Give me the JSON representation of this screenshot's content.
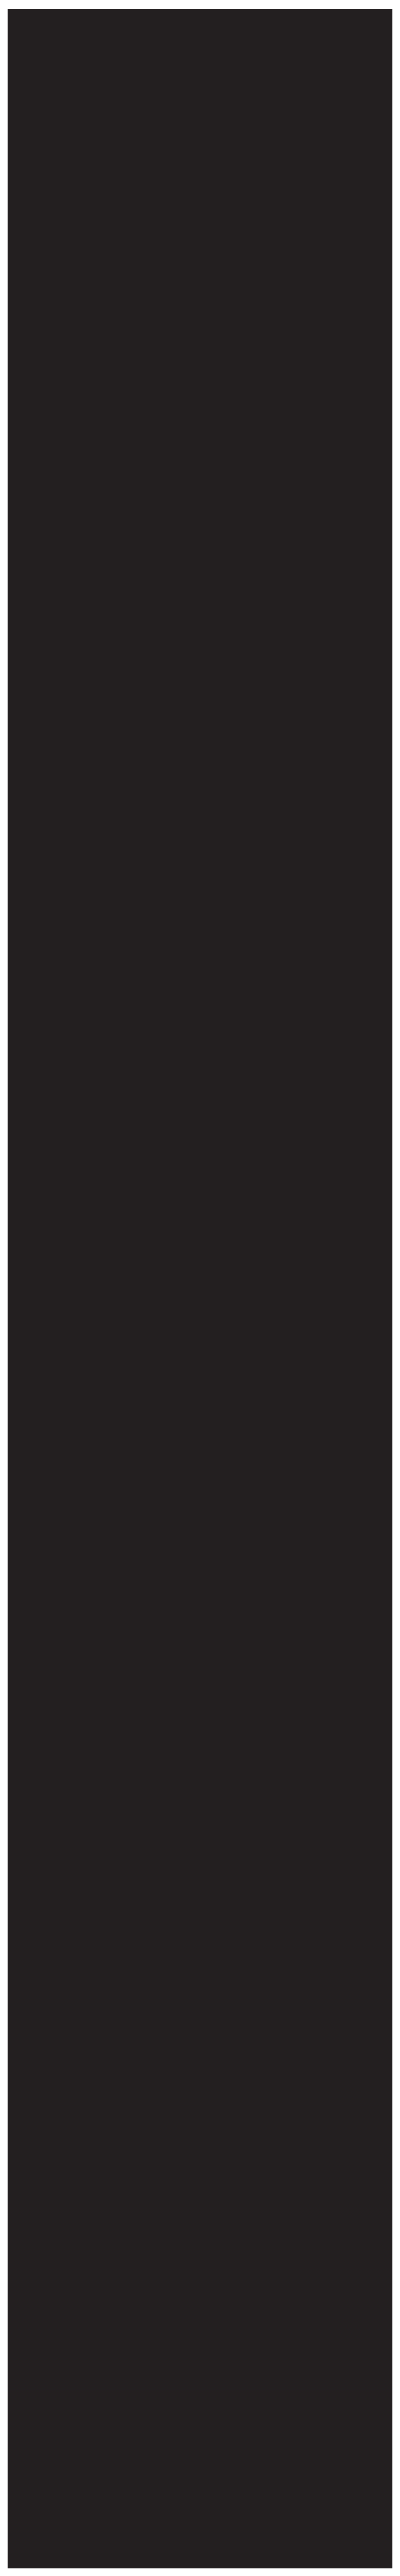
{
  "colors": {
    "page-bg": "#ffffff",
    "panel-bg": "#231f20"
  }
}
